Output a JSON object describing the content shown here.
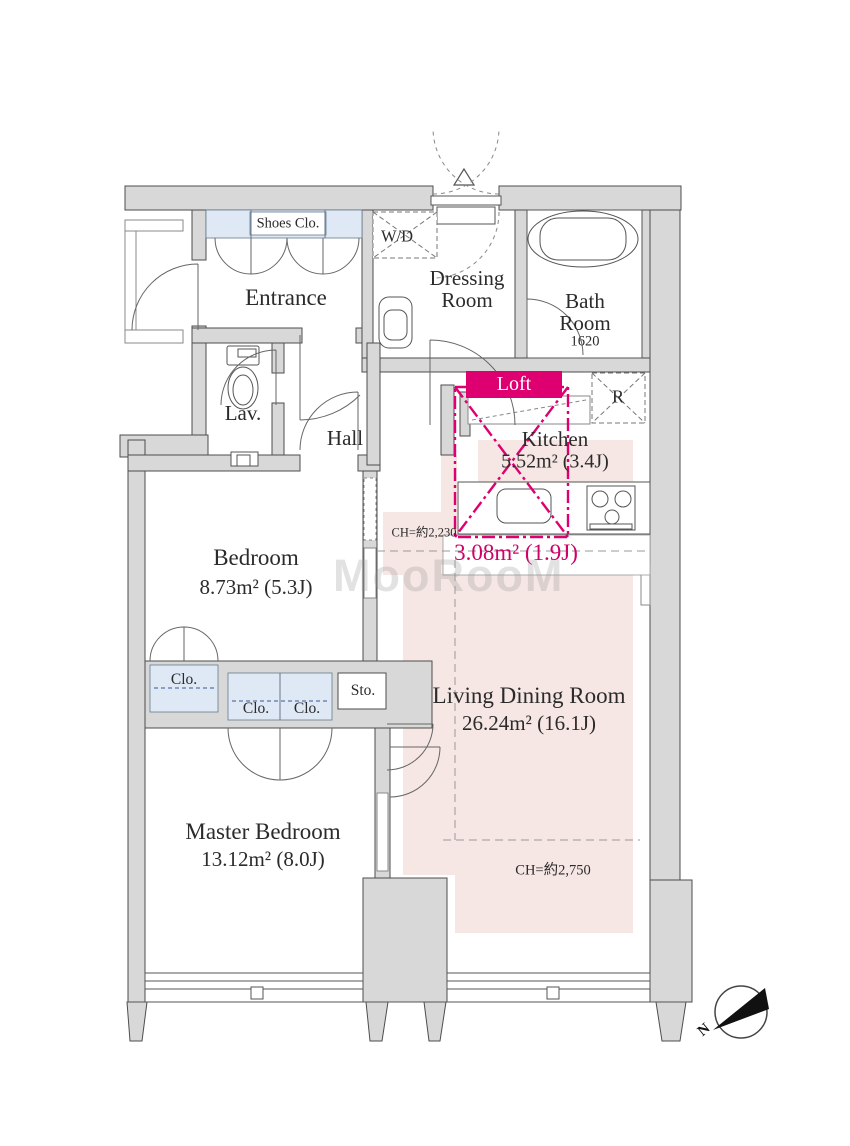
{
  "floorplan": {
    "rooms": {
      "shoes_closet": {
        "label": "Shoes Clo."
      },
      "entrance": {
        "label": "Entrance"
      },
      "washer_dryer": {
        "label": "W/D"
      },
      "dressing_room": {
        "label": "Dressing Room"
      },
      "bath_room": {
        "label": "Bath Room",
        "size": "1620"
      },
      "lavatory": {
        "label": "Lav."
      },
      "hall": {
        "label": "Hall"
      },
      "kitchen": {
        "label": "Kitchen",
        "area": "5.52m² (3.4J)"
      },
      "loft": {
        "label": "Loft",
        "area": "3.08m² (1.9J)",
        "ceiling_height": "CH=約2,230"
      },
      "refrigerator": {
        "label": "R"
      },
      "bedroom": {
        "label": "Bedroom",
        "area": "8.73m² (5.3J)"
      },
      "bedroom_closet": {
        "label": "Clo."
      },
      "master_closet_left": {
        "label": "Clo."
      },
      "master_closet_right": {
        "label": "Clo."
      },
      "storage": {
        "label": "Sto."
      },
      "living_dining_room": {
        "label": "Living Dining Room",
        "area": "26.24m² (16.1J)",
        "ceiling_height": "CH=約2,750"
      },
      "master_bedroom": {
        "label": "Master Bedroom",
        "area": "13.12m² (8.0J)"
      }
    },
    "compass": {
      "north_label": "N"
    },
    "watermark": "MooRooM",
    "colors": {
      "wall_fill": "#d8d8d8",
      "accent_magenta": "#de0070",
      "ldk_shade": "#f6e7e4",
      "closet_blue": "#dfe8f5"
    }
  }
}
